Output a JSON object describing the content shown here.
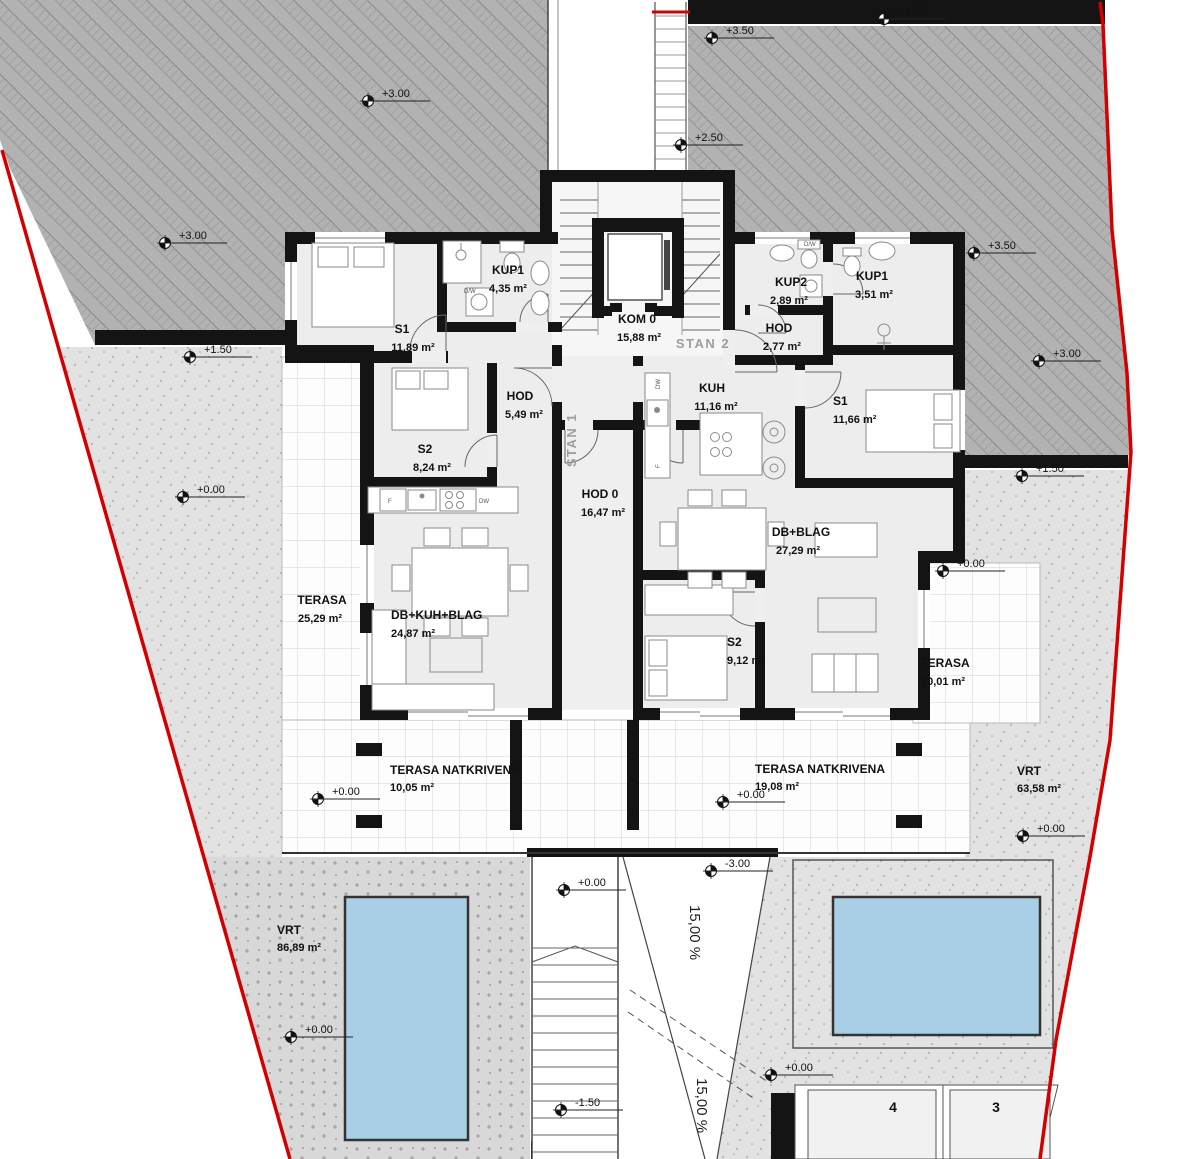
{
  "drawing": {
    "zones": {
      "stan1": "STAN 1",
      "stan2": "STAN 2"
    },
    "rooms": [
      {
        "name": "S1",
        "area": "11,89 m²"
      },
      {
        "name": "KUP1",
        "area": "4,35 m²"
      },
      {
        "name": "KOM 0",
        "area": "15,88 m²"
      },
      {
        "name": "KUP2",
        "area": "2,89 m²"
      },
      {
        "name": "HOD",
        "area": "2,77 m²"
      },
      {
        "name": "KUP1",
        "area": "3,51 m²"
      },
      {
        "name": "HOD",
        "area": "5,49 m²"
      },
      {
        "name": "KUH",
        "area": "11,16 m²"
      },
      {
        "name": "S1",
        "area": "11,66 m²"
      },
      {
        "name": "S2",
        "area": "8,24 m²"
      },
      {
        "name": "HOD 0",
        "area": "16,47 m²"
      },
      {
        "name": "DB+BLAG",
        "area": "27,29 m²"
      },
      {
        "name": "TERASA",
        "area": "25,29 m²"
      },
      {
        "name": "DB+KUH+BLAG",
        "area": "24,87 m²"
      },
      {
        "name": "S2",
        "area": "9,12 m²"
      },
      {
        "name": "TERASA",
        "area": "10,01 m²"
      },
      {
        "name": "TERASA NATKRIVENA",
        "area": "10,05 m²"
      },
      {
        "name": "TERASA NATKRIVENA",
        "area": "19,08 m²"
      },
      {
        "name": "VRT",
        "area": "63,58 m²"
      },
      {
        "name": "VRT",
        "area": "86,89 m²"
      }
    ],
    "markers": [
      {
        "value": "+3.00"
      },
      {
        "value": "+3.00"
      },
      {
        "value": "+1.50"
      },
      {
        "value": "+0.00"
      },
      {
        "value": "+4.50"
      },
      {
        "value": "+3.50"
      },
      {
        "value": "+2.50"
      },
      {
        "value": "+3.50"
      },
      {
        "value": "+3.00"
      },
      {
        "value": "+1.50"
      },
      {
        "value": "+0.00"
      },
      {
        "value": "+0.00"
      },
      {
        "value": "+0.00"
      },
      {
        "value": "+0.00"
      },
      {
        "value": "+0.00"
      },
      {
        "value": "-3.00"
      },
      {
        "value": "+0.00"
      },
      {
        "value": "-1.50"
      },
      {
        "value": "+0.00"
      }
    ],
    "ramp": {
      "slope1": "15,00 %",
      "slope2": "15,00 %"
    },
    "parking": {
      "stall_a": "4",
      "stall_b": "3"
    },
    "appliances": {
      "f1": "F",
      "dw1": "DW",
      "dw2": "DW",
      "f2": "F",
      "wm1": "D/W",
      "wm2": "D/W"
    }
  },
  "colors": {
    "boundary": "#d40000",
    "pool": "#a9cfe6",
    "wall": "#141414",
    "hatch_bg": "#b2b2b2",
    "paving": "#e2e2e2",
    "garden": "#d8d8d8"
  }
}
